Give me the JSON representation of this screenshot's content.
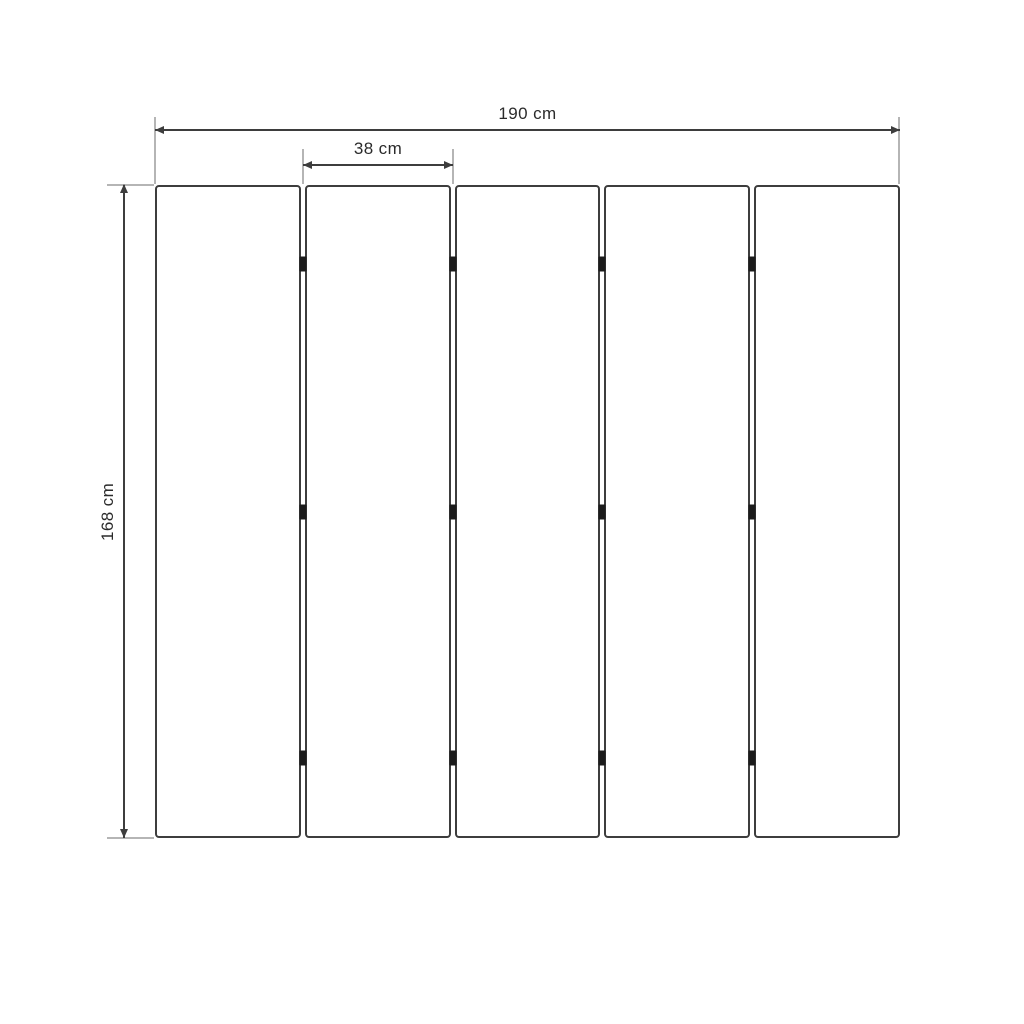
{
  "diagram": {
    "type": "panel-dimension-drawing",
    "panel_count": 5,
    "hinges_per_joint": 3,
    "hinge_positions_fraction": [
      0.121,
      0.5,
      0.877
    ],
    "labels": {
      "total_width": "190 cm",
      "panel_width": "38 cm",
      "height": "168 cm"
    },
    "colors": {
      "background": "#ffffff",
      "panel_outline": "#3d3d3d",
      "dimension_line": "#3d3d3d",
      "extension_line": "#b5b5b5",
      "hinge": "#1b1b1b",
      "label_text": "#2b2b2b"
    }
  }
}
